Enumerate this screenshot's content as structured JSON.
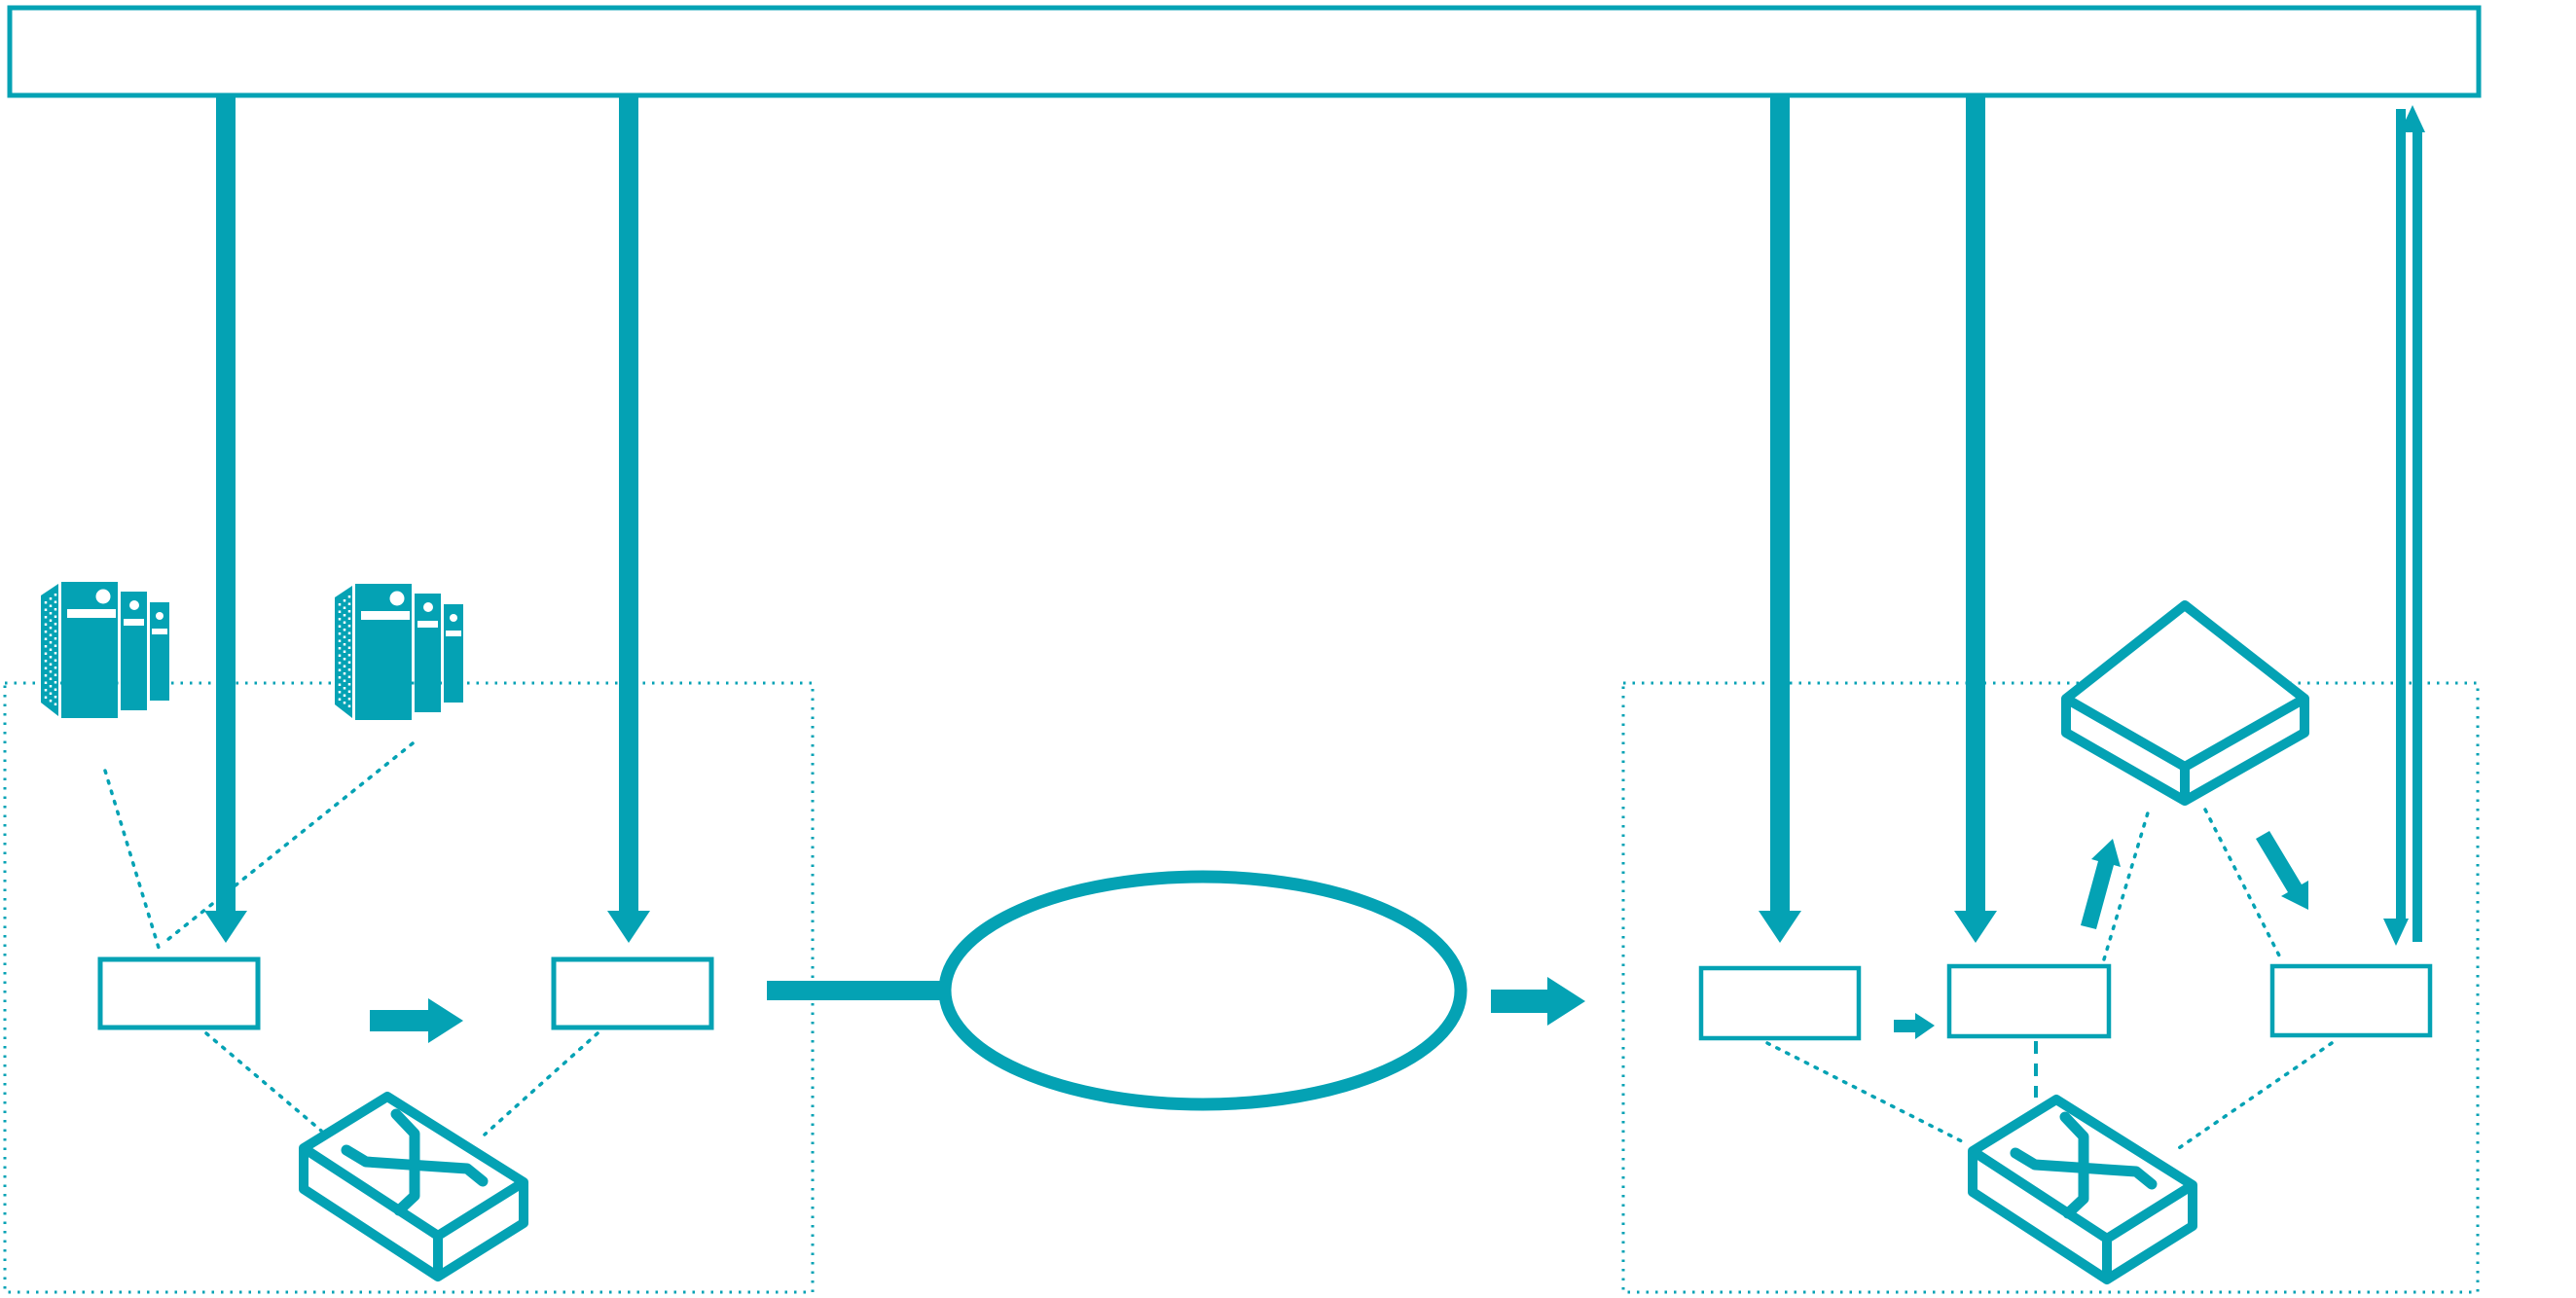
{
  "colors": {
    "accent": "#04A2B4",
    "background": "#FFFFFF"
  },
  "banner": {
    "label": ""
  },
  "cloud": {
    "label": ""
  },
  "sites": {
    "left": {
      "boxes": [
        {
          "label": ""
        },
        {
          "label": ""
        }
      ],
      "icons": {
        "servers_left": "server-stack-icon",
        "servers_right": "server-stack-icon",
        "switch": "lan-switch-icon"
      }
    },
    "right": {
      "boxes": [
        {
          "label": ""
        },
        {
          "label": ""
        },
        {
          "label": ""
        }
      ],
      "icons": {
        "switch": "lan-switch-icon",
        "hub": "flat-hub-icon"
      }
    }
  }
}
